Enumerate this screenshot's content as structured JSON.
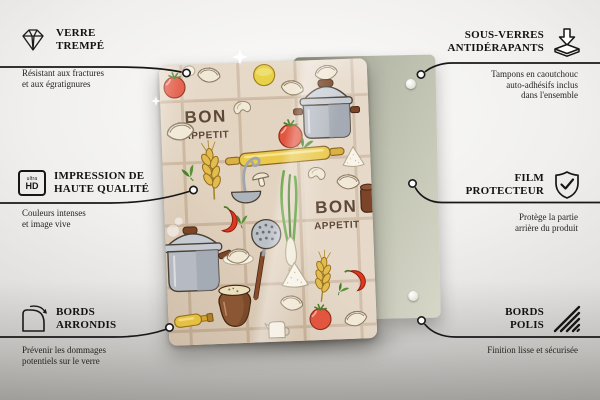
{
  "board": {
    "text_line1": "BON",
    "text_line2": "appetit",
    "text_color": "#5d4837",
    "glass_bg_color": "#e0d1be",
    "back_panel_color": "#bcbfae"
  },
  "icons": {
    "ultra_hd_top": "ultra",
    "ultra_hd_bottom": "HD"
  },
  "callouts": {
    "left": [
      {
        "icon": "diamond-icon",
        "title": "VERRE\nTREMPÉ",
        "description": "Résistant aux fractures\net aux égratignures"
      },
      {
        "icon": "ultra-hd-icon",
        "title": "IMPRESSION DE\nHAUTE QUALITÉ",
        "description": "Couleurs intenses\net image vive"
      },
      {
        "icon": "rounded-corner-icon",
        "title": "BORDS\nARRONDIS",
        "description": "Prévenir les dommages\npotentiels sur le verre"
      }
    ],
    "right": [
      {
        "icon": "anti-slip-pad-icon",
        "title": "SOUS-VERRES\nANTIDÉRAPANTS",
        "description": "Tampons en caoutchouc\nauto-adhésifs inclus\ndans l'ensemble"
      },
      {
        "icon": "shield-check-icon",
        "title": "FILM\nPROTECTEUR",
        "description": "Protège la partie\narrière du produit"
      },
      {
        "icon": "polished-edge-icon",
        "title": "BORDS\nPOLIS",
        "description": "Finition lisse et sécurisée"
      }
    ]
  }
}
